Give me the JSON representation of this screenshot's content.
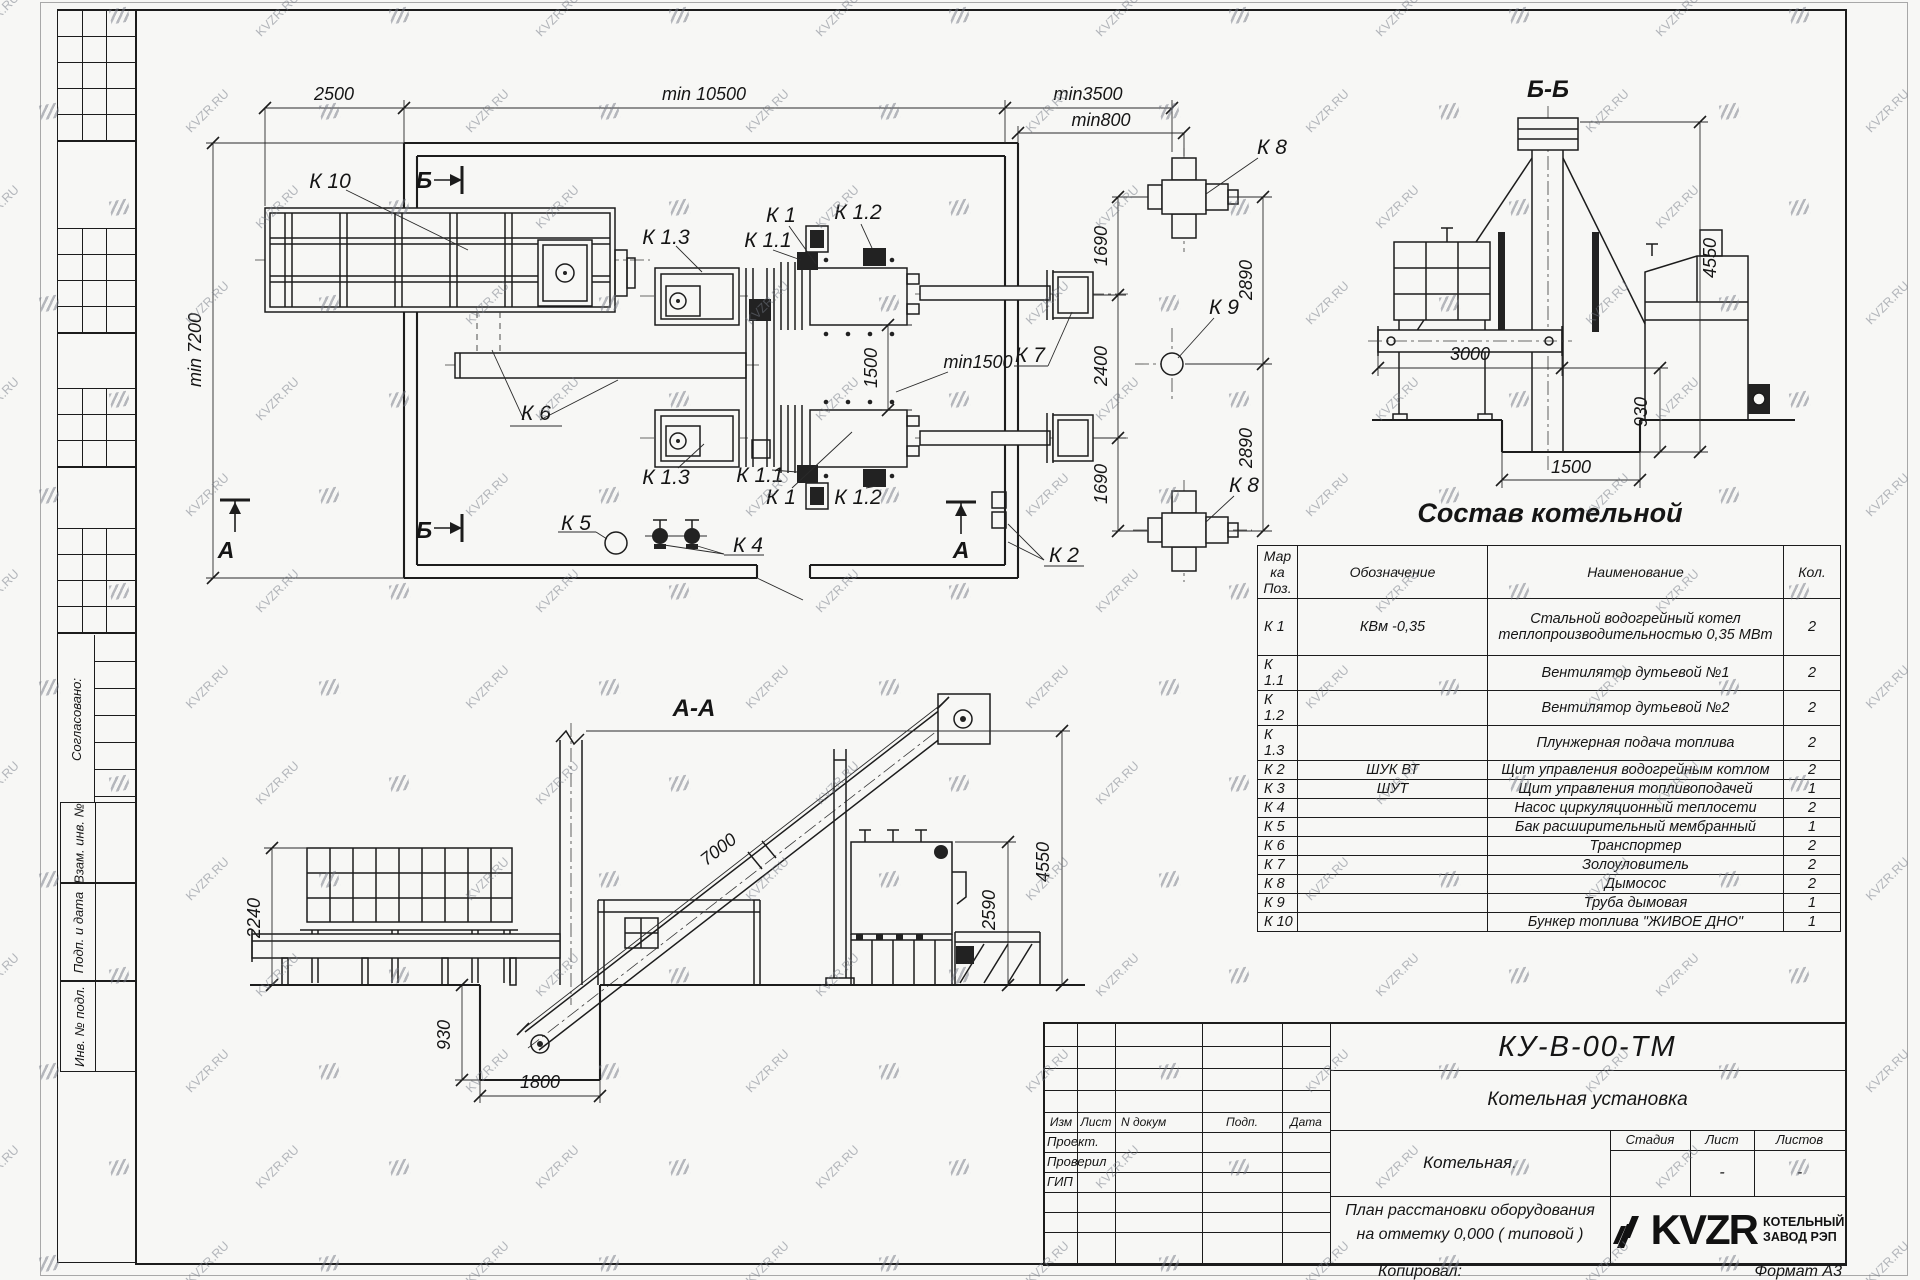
{
  "watermark": {
    "text": "KVZR.RU"
  },
  "sheet": {
    "margin": {
      "approved": "Согласовано:",
      "boxes": [
        "Взам. инв. №",
        "Подп. и дата",
        "Инв. № подл."
      ]
    }
  },
  "plan": {
    "dims": {
      "d2500": "2500",
      "d10500": "min 10500",
      "d3500": "min3500",
      "d800": "min800",
      "d7200": "min 7200",
      "d1500": "1500",
      "dmin1500": "min1500",
      "d1690a": "1690",
      "d2400": "2400",
      "d1690b": "1690",
      "d2890a": "2890",
      "d2890b": "2890"
    },
    "labels": {
      "k10": "К 10",
      "k1": "К 1",
      "k1_1": "К 1.1",
      "k1_2": "К 1.2",
      "k1_3": "К 1.3",
      "k2": "К 2",
      "k4": "К 4",
      "k5": "К 5",
      "k6": "К 6",
      "k7": "К 7",
      "k8": "К 8",
      "k9": "К 9",
      "sec_a": "А",
      "sec_b": "Б"
    }
  },
  "sections": {
    "bb": {
      "title": "Б-Б",
      "dims": {
        "d4550": "4550",
        "d3000": "3000",
        "d930": "930",
        "d1500": "1500"
      }
    },
    "aa": {
      "title": "А-А",
      "dims": {
        "d7000": "7000",
        "d2240": "2240",
        "d930": "930",
        "d1800": "1800",
        "d2590": "2590",
        "d4550": "4550"
      }
    }
  },
  "table": {
    "title": "Состав котельной",
    "headers": {
      "mark": "Марка Поз.",
      "designation": "Обозначение",
      "name": "Наименование",
      "qty": "Кол."
    },
    "rows": [
      {
        "mark": "К 1",
        "designation": "КВм -0,35",
        "name": "Стальной водогрейный котел теплопроизводительностью 0,35 МВт",
        "qty": "2"
      },
      {
        "mark": "К 1.1",
        "designation": "",
        "name": "Вентилятор дутьевой  №1",
        "qty": "2"
      },
      {
        "mark": "К 1.2",
        "designation": "",
        "name": "Вентилятор дутьевой  №2",
        "qty": "2"
      },
      {
        "mark": "К 1.3",
        "designation": "",
        "name": "Плунжерная подача топлива",
        "qty": "2"
      },
      {
        "mark": "К 2",
        "designation": "ШУК ВТ",
        "name": "Щит управления водогрейным котлом",
        "qty": "2"
      },
      {
        "mark": "К 3",
        "designation": "ШУТ",
        "name": "Щит управления топливоподачей",
        "qty": "1"
      },
      {
        "mark": "К 4",
        "designation": "",
        "name": "Насос циркуляционный теплосети",
        "qty": "2"
      },
      {
        "mark": "К 5",
        "designation": "",
        "name": "Бак расширительный мембранный",
        "qty": "1"
      },
      {
        "mark": "К 6",
        "designation": "",
        "name": "Транспортер",
        "qty": "2"
      },
      {
        "mark": "К 7",
        "designation": "",
        "name": "Золоуловитель",
        "qty": "2"
      },
      {
        "mark": "К 8",
        "designation": "",
        "name": "Дымосос",
        "qty": "2"
      },
      {
        "mark": "К 9",
        "designation": "",
        "name": "Труба дымовая",
        "qty": "1"
      },
      {
        "mark": "К 10",
        "designation": "",
        "name": "Бункер топлива  \"ЖИВОЕ ДНО\"",
        "qty": "1"
      }
    ]
  },
  "titleblock": {
    "doc_number": "КУ-В-00-ТМ",
    "product_title": "Котельная установка",
    "object_name": "Котельная.",
    "sheet_title1": "План расстановки оборудования",
    "sheet_title2": "на отметку  0,000 ( типовой )",
    "cols": {
      "izm": "Изм",
      "list": "Лист",
      "ndoc": "N докум",
      "podp": "Подп.",
      "data": "Дата"
    },
    "roles": [
      {
        "label": "Проект."
      },
      {
        "label": "Проверил"
      },
      {
        "label": "ГИП"
      }
    ],
    "stage": {
      "stage": "Стадия",
      "sheet": "Лист",
      "sheets": "Листов",
      "sheet_val": "-",
      "sheets_val": "-"
    },
    "logo": {
      "text": "KVZR",
      "cap1": "КОТЕЛЬНЫЙ",
      "cap2": "ЗАВОД РЭП"
    },
    "footer": {
      "copied": "Копировал:",
      "format": "Формат А3"
    }
  }
}
